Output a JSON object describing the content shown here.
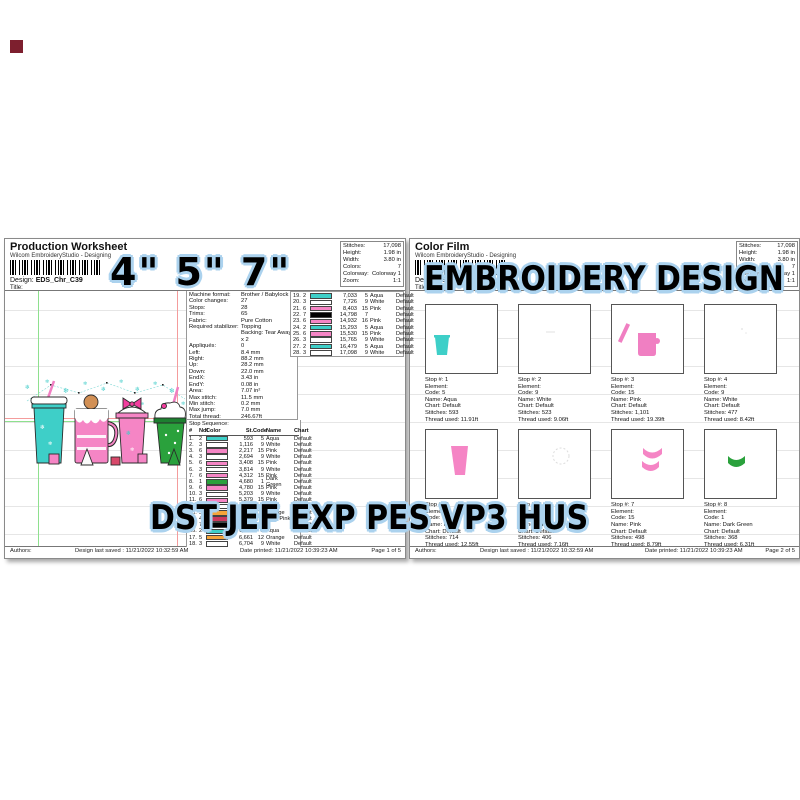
{
  "overlays": {
    "sizes": "4\" 5\" 7\"",
    "title": "EMBROIDERY DESIGN",
    "formats": "DST JEF EXP PES VP3 HUS"
  },
  "colors": {
    "aqua": "#3ecfc8",
    "white": "#ffffff",
    "pink": "#f585c5",
    "dark_green": "#2aa13c",
    "orange": "#f5a53a",
    "dark_pink": "#cc3a5e",
    "black": "#000000",
    "halo": "#abd2ee"
  },
  "left_page": {
    "title": "Production Worksheet",
    "app": "Wilcom EmbroideryStudio - Designing",
    "design_label": "Design:",
    "design_name": "EDS_Chr_C39",
    "title_label": "Title:",
    "stats": [
      {
        "label": "Stitches:",
        "value": "17,098"
      },
      {
        "label": "Height:",
        "value": "1.98 in"
      },
      {
        "label": "Width:",
        "value": "3.80 in"
      },
      {
        "label": "Colors:",
        "value": "7"
      },
      {
        "label": "Colorway:",
        "value": "Colorway 1"
      },
      {
        "label": "Zoom:",
        "value": "1:1"
      }
    ],
    "machine_info": [
      {
        "label": "Machine format:",
        "value": "Brother / Babylock"
      },
      {
        "label": "Color changes:",
        "value": "27"
      },
      {
        "label": "Stops:",
        "value": "28"
      },
      {
        "label": "Trims:",
        "value": "65"
      },
      {
        "label": "Fabric:",
        "value": "Pure Cotton"
      },
      {
        "label": "Required stabilizer:",
        "value": "Topping"
      },
      {
        "label": "",
        "value": "Backing: Tear Away x 2"
      },
      {
        "label": "Appliqués:",
        "value": "0"
      },
      {
        "label": "Left:",
        "value": "8.4 mm"
      },
      {
        "label": "Right:",
        "value": "88.2 mm"
      },
      {
        "label": "Up:",
        "value": "28.2 mm"
      },
      {
        "label": "Down:",
        "value": "22.0 mm"
      },
      {
        "label": "EndX:",
        "value": "3.43 in"
      },
      {
        "label": "EndY:",
        "value": "0.08 in"
      },
      {
        "label": "Area:",
        "value": "7.07 in²"
      },
      {
        "label": "Max stitch:",
        "value": "11.5 mm"
      },
      {
        "label": "Min stitch:",
        "value": "0.2 mm"
      },
      {
        "label": "Max jump:",
        "value": "7.0 mm"
      },
      {
        "label": "Total thread:",
        "value": "246.67ft"
      },
      {
        "label": "Total bobbin:",
        "value": "75.42ft"
      }
    ],
    "stop_sequence_label": "Stop Sequence:",
    "stop_headers": {
      "num": "#",
      "ndl": "Ndl",
      "color": "Color",
      "st": "St.",
      "code": "Code",
      "name": "Name",
      "chart": "Chart"
    },
    "stops": [
      {
        "num": "1.",
        "ndl": "2",
        "color": "#3ecfc8",
        "st": "593",
        "code": "5",
        "name": "Aqua",
        "chart": "Default"
      },
      {
        "num": "2.",
        "ndl": "3",
        "color": "#ffffff",
        "st": "1,116",
        "code": "9",
        "name": "White",
        "chart": "Default"
      },
      {
        "num": "3.",
        "ndl": "6",
        "color": "#f585c5",
        "st": "2,217",
        "code": "15",
        "name": "Pink",
        "chart": "Default"
      },
      {
        "num": "4.",
        "ndl": "3",
        "color": "#ffffff",
        "st": "2,694",
        "code": "9",
        "name": "White",
        "chart": "Default"
      },
      {
        "num": "5.",
        "ndl": "6",
        "color": "#f585c5",
        "st": "3,408",
        "code": "15",
        "name": "Pink",
        "chart": "Default"
      },
      {
        "num": "6.",
        "ndl": "3",
        "color": "#ffffff",
        "st": "3,814",
        "code": "9",
        "name": "White",
        "chart": "Default"
      },
      {
        "num": "7.",
        "ndl": "6",
        "color": "#f585c5",
        "st": "4,312",
        "code": "15",
        "name": "Pink",
        "chart": "Default"
      },
      {
        "num": "8.",
        "ndl": "1",
        "color": "#2aa13c",
        "st": "4,680",
        "code": "1",
        "name": "Dark Green",
        "chart": "Default"
      },
      {
        "num": "9.",
        "ndl": "6",
        "color": "#f585c5",
        "st": "4,780",
        "code": "15",
        "name": "Pink",
        "chart": "Default"
      },
      {
        "num": "10.",
        "ndl": "3",
        "color": "#ffffff",
        "st": "5,203",
        "code": "9",
        "name": "White",
        "chart": "Default"
      },
      {
        "num": "11.",
        "ndl": "6",
        "color": "#f585c5",
        "st": "5,379",
        "code": "15",
        "name": "Pink",
        "chart": "Default"
      },
      {
        "num": "12.",
        "ndl": "3",
        "color": "#ffffff",
        "st": "5,827",
        "code": "9",
        "name": "White",
        "chart": "Default"
      },
      {
        "num": "13.",
        "ndl": "5",
        "color": "#f5a53a",
        "st": "5,919",
        "code": "12",
        "name": "Orange",
        "chart": "Default"
      },
      {
        "num": "14.",
        "ndl": "4",
        "color": "#cc3a5e",
        "st": "6,094",
        "code": "11",
        "name": "Dark Pink",
        "chart": "Default"
      },
      {
        "num": "15.",
        "ndl": "7",
        "color": "#000000",
        "st": "6,295",
        "code": "7",
        "name": "",
        "chart": "Default"
      },
      {
        "num": "16.",
        "ndl": "2",
        "color": "#3ecfc8",
        "st": "6,459",
        "code": "5",
        "name": "Aqua",
        "chart": "Default"
      },
      {
        "num": "17.",
        "ndl": "5",
        "color": "#f5a53a",
        "st": "6,661",
        "code": "12",
        "name": "Orange",
        "chart": "Default"
      },
      {
        "num": "18.",
        "ndl": "3",
        "color": "#ffffff",
        "st": "6,704",
        "code": "9",
        "name": "White",
        "chart": "Default"
      }
    ],
    "stops_continued": [
      {
        "num": "19.",
        "ndl": "2",
        "color": "#3ecfc8",
        "st": "7,033",
        "code": "5",
        "name": "Aqua",
        "chart": "Default"
      },
      {
        "num": "20.",
        "ndl": "3",
        "color": "#ffffff",
        "st": "7,726",
        "code": "9",
        "name": "White",
        "chart": "Default"
      },
      {
        "num": "21.",
        "ndl": "6",
        "color": "#f585c5",
        "st": "8,403",
        "code": "15",
        "name": "Pink",
        "chart": "Default"
      },
      {
        "num": "22.",
        "ndl": "7",
        "color": "#000000",
        "st": "14,798",
        "code": "7",
        "name": "",
        "chart": "Default"
      },
      {
        "num": "23.",
        "ndl": "6",
        "color": "#f585c5",
        "st": "14,932",
        "code": "16",
        "name": "Pink",
        "chart": "Default"
      },
      {
        "num": "24.",
        "ndl": "2",
        "color": "#3ecfc8",
        "st": "15,293",
        "code": "5",
        "name": "Aqua",
        "chart": "Default"
      },
      {
        "num": "25.",
        "ndl": "6",
        "color": "#f585c5",
        "st": "15,530",
        "code": "15",
        "name": "Pink",
        "chart": "Default"
      },
      {
        "num": "26.",
        "ndl": "3",
        "color": "#ffffff",
        "st": "15,765",
        "code": "9",
        "name": "White",
        "chart": "Default"
      },
      {
        "num": "27.",
        "ndl": "2",
        "color": "#3ecfc8",
        "st": "16,479",
        "code": "5",
        "name": "Aqua",
        "chart": "Default"
      },
      {
        "num": "28.",
        "ndl": "3",
        "color": "#ffffff",
        "st": "17,098",
        "code": "9",
        "name": "White",
        "chart": "Default"
      }
    ],
    "footer": {
      "authors": "Authors:",
      "saved": "Design last saved : 11/21/2022 10:32:59 AM",
      "printed": "Date printed: 11/21/2022 10:39:23 AM",
      "page": "Page 1 of 5"
    }
  },
  "right_page": {
    "title": "Color Film",
    "app": "Wilcom EmbroideryStudio - Designing",
    "design_label": "Design:",
    "design_name": "EDS_Chr_C39",
    "title_label": "Title:",
    "stats": [
      {
        "label": "Stitches:",
        "value": "17,098"
      },
      {
        "label": "Height:",
        "value": "1.98 in"
      },
      {
        "label": "Width:",
        "value": "3.80 in"
      },
      {
        "label": "Colors:",
        "value": "7"
      },
      {
        "label": "Colorway:",
        "value": "Colorway 1"
      },
      {
        "label": "Zoom:",
        "value": "1:1"
      }
    ],
    "film_stops": [
      {
        "lines": [
          "Stop #: 1",
          "Element:",
          "Code: 5",
          "Name: Aqua",
          "Chart: Default",
          "Stitches: 593",
          "Thread used: 11.91ft"
        ]
      },
      {
        "lines": [
          "Stop #: 2",
          "Element:",
          "Code: 9",
          "Name: White",
          "Chart: Default",
          "Stitches: 523",
          "Thread used: 9.06ft"
        ]
      },
      {
        "lines": [
          "Stop #: 3",
          "Element:",
          "Code: 15",
          "Name: Pink",
          "Chart: Default",
          "Stitches: 1,101",
          "Thread used: 19.39ft"
        ]
      },
      {
        "lines": [
          "Stop #: 4",
          "Element:",
          "Code: 9",
          "Name: White",
          "Chart: Default",
          "Stitches: 477",
          "Thread used: 8.42ft"
        ]
      },
      {
        "lines": [
          "Stop #: 5",
          "Element:",
          "Code: 15",
          "Name: Pink",
          "Chart: Default",
          "Stitches: 714",
          "Thread used: 12.55ft"
        ]
      },
      {
        "lines": [
          "Stop #: 6",
          "Element:",
          "Code: 9",
          "Name: White",
          "Chart: Default",
          "Stitches: 406",
          "Thread used: 7.16ft"
        ]
      },
      {
        "lines": [
          "Stop #: 7",
          "Element:",
          "Code: 15",
          "Name: Pink",
          "Chart: Default",
          "Stitches: 498",
          "Thread used: 8.79ft"
        ]
      },
      {
        "lines": [
          "Stop #: 8",
          "Element:",
          "Code: 1",
          "Name: Dark Green",
          "Chart: Default",
          "Stitches: 368",
          "Thread used: 6.31ft"
        ]
      }
    ],
    "footer": {
      "authors": "Authors:",
      "saved": "Design last saved : 11/21/2022 10:32:59 AM",
      "printed": "Date printed: 11/21/2022 10:39:23 AM",
      "page": "Page 2 of 5"
    }
  }
}
